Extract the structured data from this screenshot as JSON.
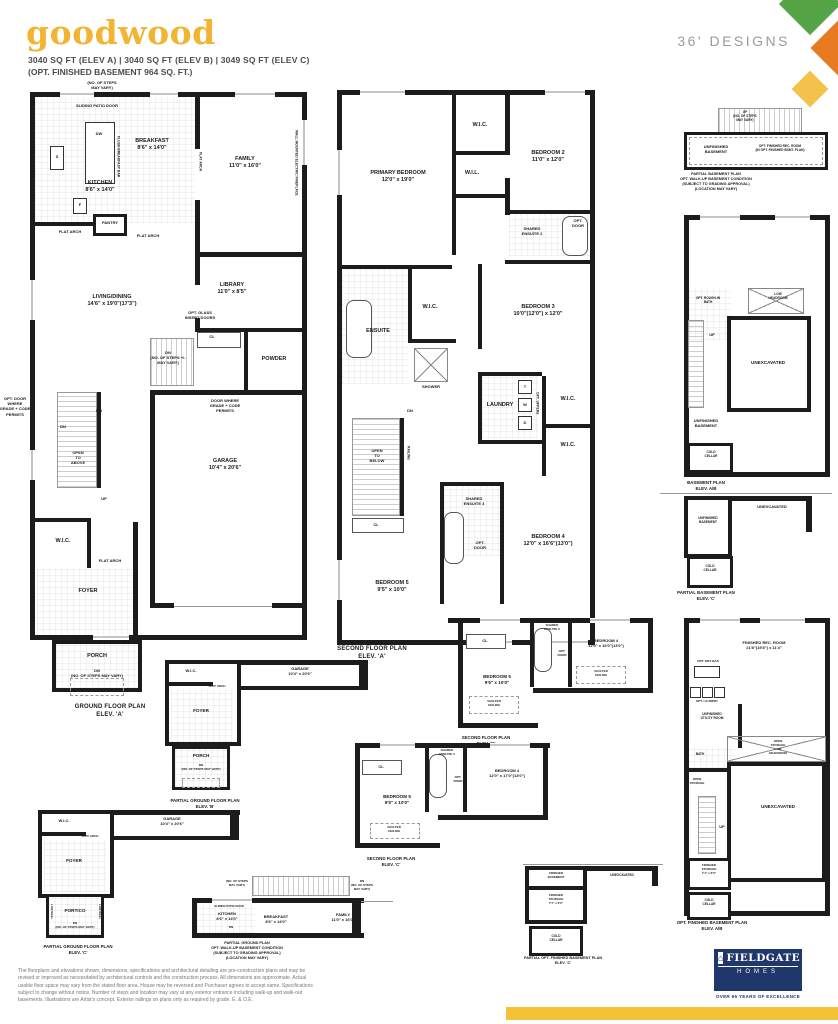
{
  "header": {
    "title": "goodwood",
    "sqft_line": "3040 SQ FT (ELEV A)   |   3040 SQ FT  (ELEV B)   |   3049 SQ FT (ELEV C)",
    "basement_line": "(OPT. FINISHED BASEMENT 964 SQ. FT.)",
    "designs_label": "36' DESIGNS"
  },
  "colors": {
    "title_yellow": "#F1B433",
    "diamond_green": "#55A546",
    "diamond_orange": "#E87B22",
    "diamond_yellow": "#F4C24A",
    "logo_navy": "#20376B",
    "bar_yellow": "#F5C237",
    "wall_black": "#1C1C1C"
  },
  "plans": {
    "ground_a": {
      "title": "GROUND FLOOR PLAN\nELEV. 'A'",
      "labels": {
        "steps_note": "(NO. OF STEPS\nMAY VARY)",
        "sliding_patio": "SLIDING PATIO DOOR",
        "dw": "DW",
        "flush_bar": "FLUSH BREAKFAST BAR",
        "breakfast": "BREAKFAST\n8'6\" x 14'0\"",
        "family": "FAMILY\n11'0\" x 16'0\"",
        "fireplace": "WALL MOUNTED ELECTRIC FIREPLACE",
        "kitchen": "KITCHEN\n8'6\" x 14'0\"",
        "s": "S",
        "f": "F",
        "pantry": "PANTRY",
        "flat_arch_kitchen": "FLAT ARCH",
        "flat_arch_breakfast": "FLAT ARCH",
        "flat_arch_family": "FLAT ARCH",
        "living_dining": "LIVING/DINING\n14'6\" x 19'0\"(17'3\")",
        "library": "LIBRARY\n11'0\" x 8'5\"",
        "opt_glass": "OPT. GLASS\nINSERT DOORS",
        "cl": "CL",
        "dn_stairs": "DN\n(NO. OF STEPS +/-\nMAY VARY)",
        "powder": "POWDER",
        "door_grade": "DOOR WHERE\nGRADE + CODE\nPERMITS",
        "opt_door_grade": "OPT. DOOR\nWHERE\nGRADE + CODE\nPERMITS",
        "dn_a": "DN",
        "dn_b": "DN",
        "open_above": "OPEN\nTO\nABOVE",
        "garage": "GARAGE\n10'4\" x 20'6\"",
        "up": "UP",
        "wic": "W.I.C.",
        "flat_arch_foyer": "FLAT ARCH",
        "foyer": "FOYER",
        "porch": "PORCH",
        "dn_porch": "DN\n(NO. OF STEPS MAY VARY)"
      }
    },
    "second_a": {
      "title": "SECOND FLOOR PLAN\nELEV. 'A'",
      "labels": {
        "wic_2": "W.I.C.",
        "bedroom2": "BEDROOM 2\n11'0\" x 12'0\"",
        "primary": "PRIMARY BEDROOM\n12'0\" x 19'0\"",
        "wil": "W.I.L.",
        "shared_ensuite2": "SHARED\nENSUITE 2",
        "opt_door2": "OPT.\nDOOR",
        "bedroom3": "BEDROOM 3\n10'0\"(12'0\") x 12'0\"",
        "wic_primary": "W.I.C.",
        "ensuite": "ENSUITE",
        "shower": "SHOWER",
        "dn": "DN",
        "laundry": "LAUNDRY",
        "t": "T",
        "w": "W",
        "d": "D",
        "opt_uppers": "OPT. UPPERS",
        "wic_3": "W.I.C.",
        "wic_4": "W.I.C.",
        "open_below": "OPEN\nTO\nBELOW",
        "railing": "RAILING",
        "shared_ensuite3": "SHARED\nENSUITE 3",
        "opt_door3": "OPT.\nDOOR",
        "bedroom4": "BEDROOM 4\n12'0\" x 16'6\"(13'0\")",
        "cl": "CL",
        "bedroom5": "BEDROOM 5\n9'5\" x 10'0\""
      }
    },
    "basement_walkup": {
      "title": "PARTIAL BASEMENT PLAN\nOPT. WALK-UP BASEMENT CONDITION\n(SUBJECT TO GRADING APPROVAL)\n(LOCATION MAY VARY)",
      "labels": {
        "up_note": "UP\n(NO. OF STEPS\nMAY VARY)",
        "unfinished": "UNFINISHED\nBASEMENT",
        "opt_rec": "OPT. FINISHED REC. ROOM\n(IN OPT. FINISHED BSMT. PLAN)"
      }
    },
    "basement_ab": {
      "title": "BASEMENT PLAN\nELEV. A/B",
      "labels": {
        "rough_in": "OPT. ROUGH-IN\nBATH",
        "low_headroom": "LOW\nHEADROOM",
        "up": "UP",
        "unexcavated": "UNEXCAVATED",
        "unfinished": "UNFINISHED\nBASEMENT",
        "cold_cellar": "COLD\nCELLAR"
      }
    },
    "basement_c": {
      "title": "PARTIAL BASEMENT PLAN\nELEV. 'C'",
      "labels": {
        "unexcavated": "UNEXCAVATED",
        "unfinished": "UNFINISHED\nBASEMENT",
        "cold_cellar": "COLD\nCELLAR"
      }
    },
    "finished_basement_ab": {
      "title": "OPT. FINISHED BASEMENT PLAN\nELEV. A/B",
      "labels": {
        "rec_room": "FINISHED REC. ROOM\n21'8\"(19'8\") x 11'4\"",
        "opt_wet_bar": "OPT. WET BAR",
        "opt_laundry": "OPT. LAUNDRY",
        "utility": "UNFINISHED\nUTILITY ROOM",
        "bath": "BATH",
        "open_storage_x": "OPEN\nSTORAGE\nLOW\nHEADROOM",
        "open_storage": "OPEN\nSTORAGE",
        "up": "UP",
        "unexcavated": "UNEXCAVATED",
        "finished_storage": "FINISHED\nSTORAGE\n7'1\" x 6'0\"",
        "cold_cellar": "COLD\nCELLAR"
      }
    },
    "finished_basement_c": {
      "title": "PARTIAL OPT. FINISHED BASEMENT PLAN\nELEV. 'C'",
      "labels": {
        "finished_basement": "FINISHED\nBASEMENT",
        "unexcavated": "UNEXCAVATED",
        "finished_storage": "FINISHED\nSTORAGE\n7'1\" x 6'0\"",
        "cold_cellar": "COLD\nCELLAR"
      }
    },
    "ground_b": {
      "title": "PARTIAL GROUND FLOOR PLAN\nELEV. 'B'",
      "labels": {
        "wic": "W.I.C.",
        "flat_arch": "FLAT ARCH",
        "foyer": "FOYER",
        "garage": "GARAGE\n10'4\" x 20'6\"",
        "porch": "PORCH",
        "dn": "DN\n(NO. OF STEPS MAY VARY)"
      }
    },
    "ground_c": {
      "title": "PARTIAL GROUND FLOOR PLAN\nELEV. 'C'",
      "labels": {
        "wic": "W.I.C.",
        "flat_arch": "FLAT ARCH",
        "foyer": "FOYER",
        "garage": "GARAGE\n10'4\" x 20'6\"",
        "portico": "PORTICO",
        "low_wall_left": "LOW WALL",
        "low_wall_right": "LOW WALL",
        "dn": "DN\n(NO. OF STEPS MAY VARY)"
      }
    },
    "second_b": {
      "title": "SECOND FLOOR PLAN\nELEV. 'B'",
      "labels": {
        "cl": "CL",
        "shared_ensuite3": "SHARED\nENSUITE 3",
        "opt_door": "OPT.\nDOOR",
        "bedroom4": "BEDROOM 4\n12'0\" x 16'0\"(13'0\")",
        "vaulted_1": "VAULTED\nCEILING",
        "bedroom5": "BEDROOM 5\n9'5\" x 10'0\"",
        "vaulted_2": "VAULTED\nCEILING"
      }
    },
    "second_c": {
      "title": "SECOND FLOOR PLAN\nELEV. 'C'",
      "labels": {
        "cl": "CL",
        "shared_ensuite3": "SHARED\nENSUITE 3",
        "opt_door": "OPT.\nDOOR",
        "bedroom4": "BEDROOM 4\n12'0\" x 17'0\"(13'0\")",
        "bedroom5": "BEDROOM 5\n9'5\" x 10'0\"",
        "vaulted": "VAULTED\nCEILING"
      }
    },
    "ground_walkup": {
      "title": "PARTIAL GROUND PLAN\nOPT. WALK-UP BASEMENT CONDITION\n(SUBJECT TO GRADING APPROVAL)\n(LOCATION MAY VARY)",
      "labels": {
        "steps_note": "(NO. OF STEPS\nMAY VARY)",
        "dn_note": "DN\n(NO. OF STEPS\nMAY VARY)",
        "sliding_patio": "SLIDING PATIO DOOR",
        "kitchen": "KITCHEN\n8'6\" x 14'0\"",
        "breakfast": "BREAKFAST\n8'6\" x 14'0\"",
        "family": "FAMILY\n11'0\" x 16'0\"",
        "dn": "DN"
      }
    }
  },
  "footer": {
    "disclaimer": "The floorplans and elevations shown, dimensions, specifications and architectural detailing are pre-construction plans and may be revised or improved as necessitated by architectural controls and the construction process. All dimensions are approximate. Actual usable floor space may vary from the stated floor area. House may be reversed and Purchaser agrees to accept same. Specifications subject to change without notice. Number of steps and location may vary at any exterior entrance including walk-up and walk-out basements. Illustrations are Artist's concept. Exterior railings on plans only as required by grade. E. & O.E.",
    "logo": {
      "name": "FIELDGATE",
      "sub": "HOMES",
      "tagline": "OVER 65 YEARS OF EXCELLENCE"
    }
  }
}
